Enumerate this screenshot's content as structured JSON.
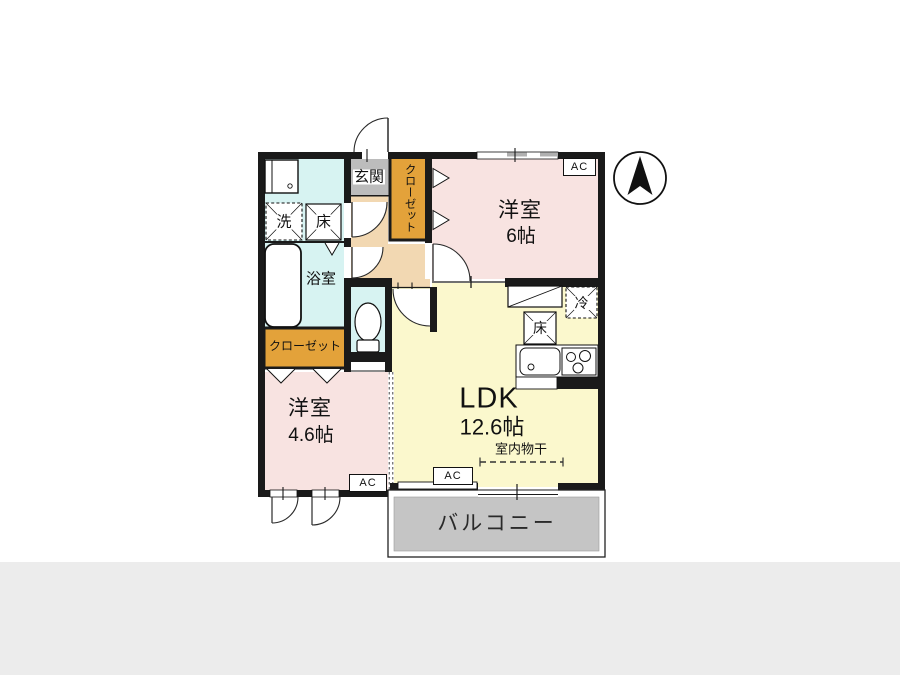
{
  "labels": {
    "entrance": "玄関",
    "closet_upper": "クローゼット",
    "closet_lower": "クローゼット",
    "washer": "洗",
    "floor_hatch_wash": "床",
    "bath": "浴室",
    "room1_name": "洋室",
    "room1_size": "6帖",
    "room2_name": "洋室",
    "room2_size": "4.6帖",
    "ldk_name": "LDK",
    "ldk_size": "12.6帖",
    "fridge": "冷",
    "floor_hatch_ldk": "床",
    "indoor_drying": "室内物干",
    "balcony": "バルコニー",
    "ac_upper": "AC",
    "ac_ldk": "AC",
    "ac_lower": "AC"
  },
  "colors": {
    "wall": "#1a1a1a",
    "room_pink": "#f8e3e1",
    "ldk_yellow": "#fbf8cd",
    "water_blue": "#d7f3f2",
    "hall_peach": "#f2d8b2",
    "closet_orange": "#e3a23a",
    "entrance_gray": "#bcbcbc",
    "balcony_gray": "#c5c5c5",
    "page_band_gray": "#ececec"
  }
}
